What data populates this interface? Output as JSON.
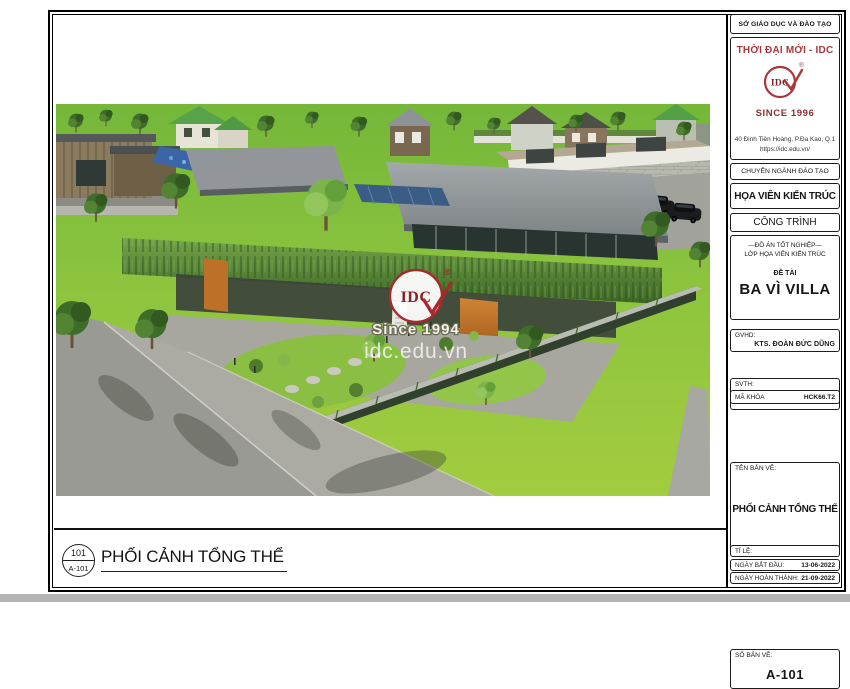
{
  "colors": {
    "brand_red": "#a8383b",
    "dark_red": "#7c2022",
    "grass_green": "#8cc43e"
  },
  "title_block": {
    "department": "SỞ GIÁO DỤC VÀ ĐÀO TẠO",
    "org_name": "THỜI ĐẠI MỚI - IDC",
    "logo_text": "IDC",
    "logo_reg": "®",
    "since": "SINCE 1996",
    "address": "40 Đinh Tiên Hoàng, P.Đa Kao, Q.1",
    "website": "https://idc.edu.vn/",
    "training_label": "CHUYÊN NGÀNH ĐÀO TẠO",
    "training_major": "HỌA VIÊN KIẾN TRÚC",
    "project_label": "CÔNG TRÌNH",
    "project_type": "—ĐỒ ÁN TỐT NGHIỆP—",
    "project_class": "LỚP HỌA VIÊN KIẾN TRÚC",
    "topic_label": "ĐỀ TÀI",
    "topic_name": "BA VÌ VILLA",
    "advisor_label": "GVHD:",
    "advisor_name": "KTS. ĐOÀN ĐỨC DŨNG",
    "student_label": "SVTH:",
    "student_name": "VÕ LÊ KIỀU ANH",
    "code_label": "MÃ KHÓA",
    "code_value": "HCK66.T2",
    "drawing_label": "TÊN BẢN VẼ:",
    "drawing_name": "PHỐI CẢNH TỔNG THỂ",
    "sheet_label": "SỐ BẢN VẼ:",
    "sheet_number": "A-101",
    "scale_label": "TỈ LỆ:",
    "start_label": "NGÀY BẮT ĐẦU:",
    "start_date": "13-06-2022",
    "finish_label": "NGÀY HOÀN THÀNH:",
    "finish_date": "21-09-2022"
  },
  "footer": {
    "detail_number": "101",
    "detail_sheet": "A-101",
    "view_title": "PHỐI CẢNH TỔNG THỂ"
  },
  "watermark": {
    "logo_text": "IDC",
    "logo_reg": "®",
    "since": "Since 1994",
    "website": "idc.edu.vn"
  }
}
